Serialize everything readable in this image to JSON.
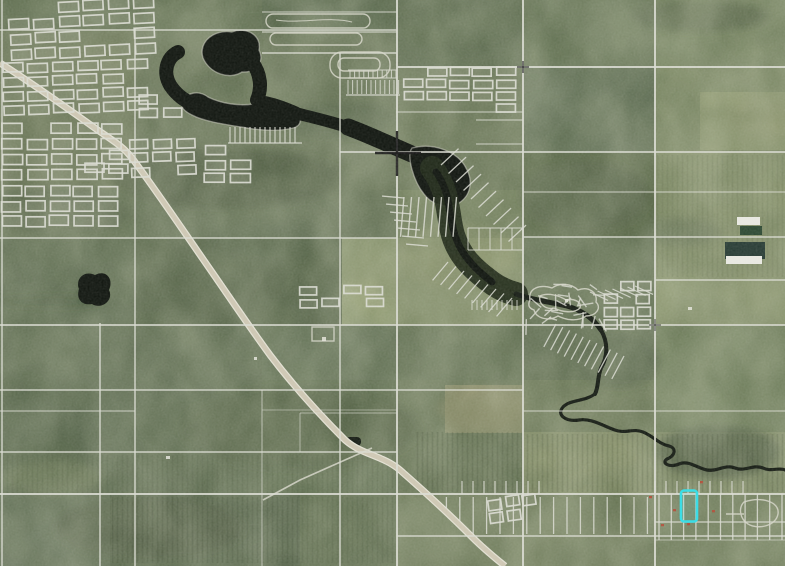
{
  "app": {
    "name": "gis-aerial-parcel-viewer"
  },
  "map": {
    "view": "aerial-imagery-with-cadastral-parcel-overlay",
    "width_px": 785,
    "height_px": 566,
    "features": {
      "lake": "large dark lake in upper-left quadrant narrowing to a wooded creek corridor",
      "creek": "creek meandering southeast to lower-right corner",
      "town": "dense town street grid, upper-left",
      "highway": "diagonal highway from upper-left to lower-right",
      "subdivisions": "lakeside strip-lot subdivisions along lake and creek",
      "farm_fields": "section-line grid over cultivated fields",
      "selected_parcel": "cyan highlighted parcel, lower right"
    },
    "selected_parcel": {
      "x": 681,
      "y": 490,
      "width": 16,
      "height": 31
    }
  },
  "colors": {
    "terrain_base": "#5d6a4b",
    "terrain_dark": "#3c4a31",
    "terrain_light": "#9aa173",
    "water": "#0e130d",
    "swamp_corridor": "#1e2817",
    "parcel_line": "#dadbd2",
    "road_fill": "#cdc6b2",
    "road_edge": "#e2e0d2",
    "building": "#e8e8e1",
    "lagoon_teal": "#263a33",
    "pond_green": "#2a4630",
    "highlight": "#3bdde6",
    "marker_red": "#b5432f",
    "crosshair": "#151515"
  }
}
